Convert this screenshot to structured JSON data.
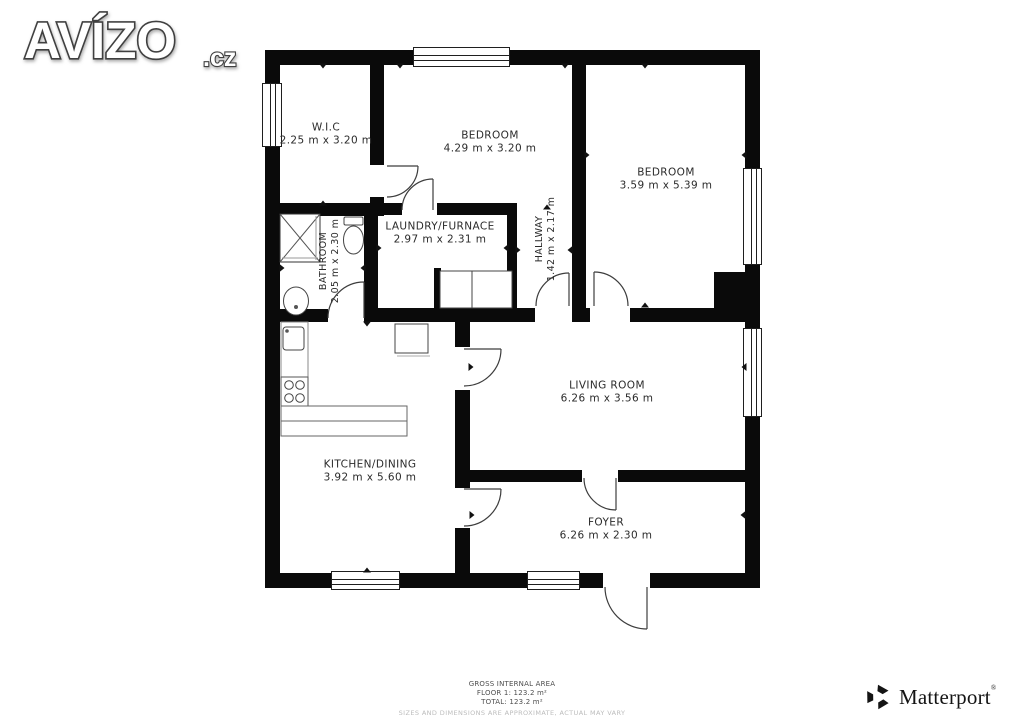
{
  "branding": {
    "logo_text": "AVÍZO",
    "logo_suffix": ".cz",
    "matterport_name": "Matterport",
    "matterport_mark": "®"
  },
  "rooms": [
    {
      "id": "wic",
      "name": "W.I.C",
      "dims": "2.25 m x 3.20 m"
    },
    {
      "id": "bedroom1",
      "name": "BEDROOM",
      "dims": "4.29 m x 3.20 m"
    },
    {
      "id": "bedroom2",
      "name": "BEDROOM",
      "dims": "3.59 m x 5.39 m"
    },
    {
      "id": "laundry",
      "name": "LAUNDRY/FURNACE",
      "dims": "2.97 m x 2.31 m"
    },
    {
      "id": "bathroom",
      "name": "BATHROOM",
      "dims": "2.05 m x 2.30 m"
    },
    {
      "id": "hallway",
      "name": "HALLWAY",
      "dims": "1.42 m x 2.17 m"
    },
    {
      "id": "living",
      "name": "LIVING ROOM",
      "dims": "6.26 m x 3.56 m"
    },
    {
      "id": "kitchen",
      "name": "KITCHEN/DINING",
      "dims": "3.92 m x 5.60 m"
    },
    {
      "id": "foyer",
      "name": "FOYER",
      "dims": "6.26 m x 2.30 m"
    }
  ],
  "footer": {
    "title": "GROSS INTERNAL AREA",
    "floor": "FLOOR 1: 123.2 m²",
    "total": "TOTAL: 123.2 m²",
    "disclaimer": "SIZES AND DIMENSIONS ARE APPROXIMATE, ACTUAL MAY VARY"
  },
  "colors": {
    "wall": "#0a0a0a",
    "room_label": "#2b2b2b",
    "footer_text": "#4f4f4f",
    "disclaimer_text": "#bcbcbc",
    "logo_fill": "#ffffff",
    "logo_outline": "#404040",
    "matterport_black": "#141414"
  }
}
